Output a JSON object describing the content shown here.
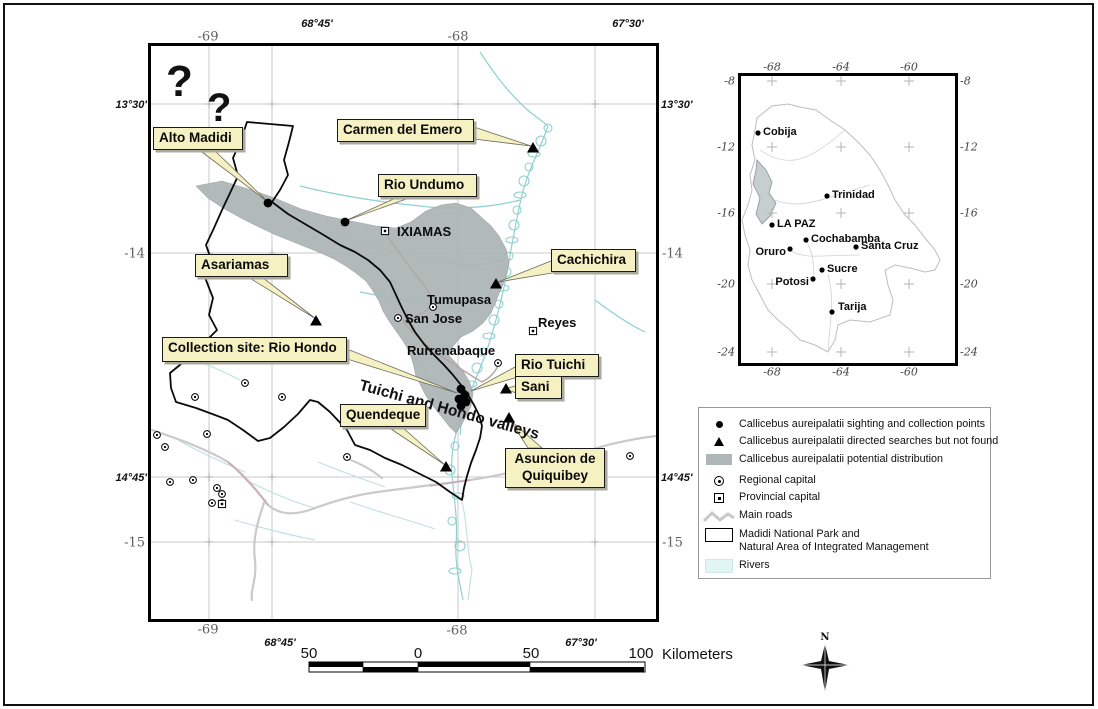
{
  "colors": {
    "callout_fill": "#F6F1C3",
    "distribution": "#AEB6B6",
    "river": "#8FD0D0",
    "river_faint": "#BFE0E0",
    "road": "#CACACA",
    "road_accent": "#D2A2AC",
    "route": "#B5A5A0",
    "grid": "#C9C9C9",
    "frame": "#000000",
    "inset_outline": "#BDBDBD",
    "inset_region": "#C6CECE",
    "legend_river": "#E2F5F5"
  },
  "main_map": {
    "question_marks": [
      {
        "t": "?",
        "x": 166,
        "y": 60,
        "size": 44
      },
      {
        "t": "?",
        "x": 207,
        "y": 88,
        "size": 40
      }
    ],
    "axis": [
      {
        "t": "68°45'",
        "x": 317,
        "y": 24,
        "s": "deg",
        "a": "c"
      },
      {
        "t": "67°30'",
        "x": 628,
        "y": 24,
        "s": "deg",
        "a": "c"
      },
      {
        "t": "-69",
        "x": 208,
        "y": 37,
        "s": "serif",
        "a": "c"
      },
      {
        "t": "-68",
        "x": 458,
        "y": 37,
        "s": "serif",
        "a": "c"
      },
      {
        "t": "13°30'",
        "x": 147,
        "y": 105,
        "s": "deg",
        "a": "e"
      },
      {
        "t": "-14",
        "x": 145,
        "y": 254,
        "s": "serif",
        "a": "e"
      },
      {
        "t": "14°45'",
        "x": 147,
        "y": 478,
        "s": "deg",
        "a": "e"
      },
      {
        "t": "-15",
        "x": 145,
        "y": 543,
        "s": "serif",
        "a": "e"
      },
      {
        "t": "13°30'",
        "x": 661,
        "y": 105,
        "s": "deg",
        "a": "s"
      },
      {
        "t": "-14",
        "x": 662,
        "y": 254,
        "s": "serif",
        "a": "s"
      },
      {
        "t": "14°45'",
        "x": 661,
        "y": 478,
        "s": "deg",
        "a": "s"
      },
      {
        "t": "-15",
        "x": 662,
        "y": 543,
        "s": "serif",
        "a": "s"
      },
      {
        "t": "-69",
        "x": 208,
        "y": 630,
        "s": "serif",
        "a": "c"
      },
      {
        "t": "68°45'",
        "x": 280,
        "y": 643,
        "s": "deg",
        "a": "c"
      },
      {
        "t": "-68",
        "x": 457,
        "y": 631,
        "s": "serif",
        "a": "c"
      },
      {
        "t": "67°30'",
        "x": 581,
        "y": 643,
        "s": "deg",
        "a": "c"
      }
    ],
    "valley_label": {
      "t": "Tuichi and Hondo valleys",
      "x": 362,
      "y": 377,
      "rot": 15.5
    },
    "callouts": [
      {
        "id": "alto-madidi",
        "lines": [
          "Alto Madidi"
        ],
        "box": [
          153,
          127,
          90,
          22
        ],
        "beam": [
          198,
          149,
          213,
          149
        ],
        "target": [
          268,
          202
        ]
      },
      {
        "id": "carmen-del-emero",
        "lines": [
          "Carmen del Emero"
        ],
        "box": [
          337,
          119,
          137,
          23
        ],
        "beam": [
          474,
          127,
          474,
          139
        ],
        "target": [
          531,
          146
        ]
      },
      {
        "id": "rio-undumo",
        "lines": [
          "Rio Undumo"
        ],
        "box": [
          378,
          174,
          99,
          23
        ],
        "beam": [
          398,
          197,
          412,
          197
        ],
        "target": [
          345,
          221
        ]
      },
      {
        "id": "cachichira",
        "lines": [
          "Cachichira"
        ],
        "box": [
          551,
          249,
          85,
          23
        ],
        "beam": [
          551,
          261,
          558,
          272
        ],
        "target": [
          498,
          282
        ]
      },
      {
        "id": "asariamas",
        "lines": [
          "Asariamas"
        ],
        "box": [
          195,
          254,
          93,
          23
        ],
        "beam": [
          248,
          277,
          262,
          277
        ],
        "target": [
          316,
          319
        ]
      },
      {
        "id": "collection-site-rio-hondo",
        "lines": [
          "Collection site: Rio Hondo"
        ],
        "box": [
          162,
          337,
          185,
          25
        ],
        "beam": [
          347,
          349,
          347,
          359
        ],
        "target": [
          457,
          393
        ]
      },
      {
        "id": "rio-tuichi",
        "lines": [
          "Rio Tuichi"
        ],
        "box": [
          515,
          354,
          84,
          22
        ],
        "beam": [
          515,
          367,
          521,
          376
        ],
        "target": [
          471,
          391
        ]
      },
      {
        "id": "sani",
        "lines": [
          "Sani"
        ],
        "box": [
          515,
          376,
          47,
          22
        ],
        "beam": [
          515,
          386,
          519,
          394
        ],
        "target": [
          505,
          389
        ]
      },
      {
        "id": "quendeque",
        "lines": [
          "Quendeque"
        ],
        "box": [
          340,
          404,
          84,
          23
        ],
        "beam": [
          388,
          427,
          402,
          427
        ],
        "target": [
          445,
          465
        ]
      },
      {
        "id": "asuncion-de-quiquibey",
        "lines": [
          "Asuncion de",
          "Quiquibey"
        ],
        "box": [
          505,
          448,
          100,
          40
        ],
        "beam": [
          528,
          448,
          542,
          448
        ],
        "target": [
          510,
          420
        ]
      }
    ],
    "sites": {
      "dots": [
        [
          268,
          203
        ],
        [
          345,
          222
        ],
        [
          461,
          389
        ],
        [
          465,
          395
        ],
        [
          459,
          399
        ],
        [
          466,
          402
        ],
        [
          461,
          406
        ]
      ],
      "triangles": [
        [
          533,
          148
        ],
        [
          496,
          284
        ],
        [
          316,
          321
        ],
        [
          506,
          389
        ],
        [
          509,
          418
        ],
        [
          446,
          467
        ]
      ]
    },
    "towns": [
      {
        "n": "IXIAMAS",
        "sym": "prov",
        "sx": 385,
        "sy": 231,
        "lx": 397,
        "ly": 224
      },
      {
        "n": "Tumupasa",
        "sym": "reg",
        "sx": 433,
        "sy": 307,
        "lx": 427,
        "ly": 292
      },
      {
        "n": "San Jose",
        "sym": "reg",
        "sx": 398,
        "sy": 318,
        "lx": 405,
        "ly": 311
      },
      {
        "n": "Reyes",
        "sym": "prov",
        "sx": 533,
        "sy": 331,
        "lx": 538,
        "ly": 315
      },
      {
        "n": "Rurrenabaque",
        "sym": "reg",
        "sx": 498,
        "sy": 363,
        "lx": 407,
        "ly": 343
      }
    ],
    "regional_capitals": [
      [
        245,
        383
      ],
      [
        195,
        397
      ],
      [
        282,
        397
      ],
      [
        157,
        435
      ],
      [
        165,
        447
      ],
      [
        207,
        434
      ],
      [
        170,
        482
      ],
      [
        193,
        480
      ],
      [
        217,
        488
      ],
      [
        222,
        494
      ],
      [
        212,
        503
      ],
      [
        222,
        503
      ],
      [
        347,
        457
      ],
      [
        630,
        456
      ]
    ],
    "provincial_capitals": [
      [
        222,
        504
      ]
    ]
  },
  "scale_bar": {
    "labels": [
      "50",
      "0",
      "50",
      "100"
    ],
    "unit": "Kilometers"
  },
  "north": "N",
  "legend": {
    "items": [
      {
        "sym": "dot",
        "lines": [
          "Callicebus aureipalatii sighting and collection points"
        ],
        "y": 10
      },
      {
        "sym": "tri",
        "lines": [
          "Callicebus aureipalatii directed searches but not found"
        ],
        "y": 27
      },
      {
        "sym": "dist",
        "lines": [
          "Callicebus aureipalatii potential distribution"
        ],
        "y": 45
      },
      {
        "sym": "reg",
        "lines": [
          "Regional capital"
        ],
        "y": 66
      },
      {
        "sym": "prov",
        "lines": [
          "Provincial capital"
        ],
        "y": 83
      },
      {
        "sym": "roads",
        "lines": [
          "Main roads"
        ],
        "y": 101
      },
      {
        "sym": "park",
        "lines": [
          "Madidi National Park and",
          "Natural Area of Integrated Management"
        ],
        "y": 120
      },
      {
        "sym": "river",
        "lines": [
          "Rivers"
        ],
        "y": 151
      }
    ]
  },
  "inset": {
    "axis": [
      {
        "t": "-68",
        "x": 772,
        "y": 67,
        "a": "c"
      },
      {
        "t": "-64",
        "x": 841,
        "y": 67,
        "a": "c"
      },
      {
        "t": "-60",
        "x": 909,
        "y": 67,
        "a": "c"
      },
      {
        "t": "-68",
        "x": 772,
        "y": 372,
        "a": "c"
      },
      {
        "t": "-64",
        "x": 841,
        "y": 372,
        "a": "c"
      },
      {
        "t": "-60",
        "x": 909,
        "y": 372,
        "a": "c"
      },
      {
        "t": "-8",
        "x": 735,
        "y": 81,
        "a": "e"
      },
      {
        "t": "-12",
        "x": 735,
        "y": 147,
        "a": "e"
      },
      {
        "t": "-16",
        "x": 735,
        "y": 213,
        "a": "e"
      },
      {
        "t": "-20",
        "x": 735,
        "y": 284,
        "a": "e"
      },
      {
        "t": "-24",
        "x": 735,
        "y": 352,
        "a": "e"
      },
      {
        "t": "-8",
        "x": 960,
        "y": 81,
        "a": "s"
      },
      {
        "t": "-12",
        "x": 960,
        "y": 147,
        "a": "s"
      },
      {
        "t": "-16",
        "x": 960,
        "y": 213,
        "a": "s"
      },
      {
        "t": "-20",
        "x": 960,
        "y": 284,
        "a": "s"
      },
      {
        "t": "-24",
        "x": 960,
        "y": 352,
        "a": "s"
      }
    ],
    "cities": [
      {
        "n": "Cobija",
        "x": 758,
        "y": 133,
        "side": "r"
      },
      {
        "n": "Trinidad",
        "x": 827,
        "y": 196,
        "side": "r"
      },
      {
        "n": "LA PAZ",
        "x": 772,
        "y": 225,
        "side": "r"
      },
      {
        "n": "Cochabamba",
        "x": 806,
        "y": 240,
        "side": "r"
      },
      {
        "n": "Oruro",
        "x": 790,
        "y": 249,
        "side": "lb"
      },
      {
        "n": "Santa Cruz",
        "x": 856,
        "y": 247,
        "side": "r"
      },
      {
        "n": "Sucre",
        "x": 822,
        "y": 270,
        "side": "r"
      },
      {
        "n": "Potosi",
        "x": 813,
        "y": 279,
        "side": "lb"
      },
      {
        "n": "Tarija",
        "x": 832,
        "y": 312,
        "side": "ra"
      }
    ]
  }
}
